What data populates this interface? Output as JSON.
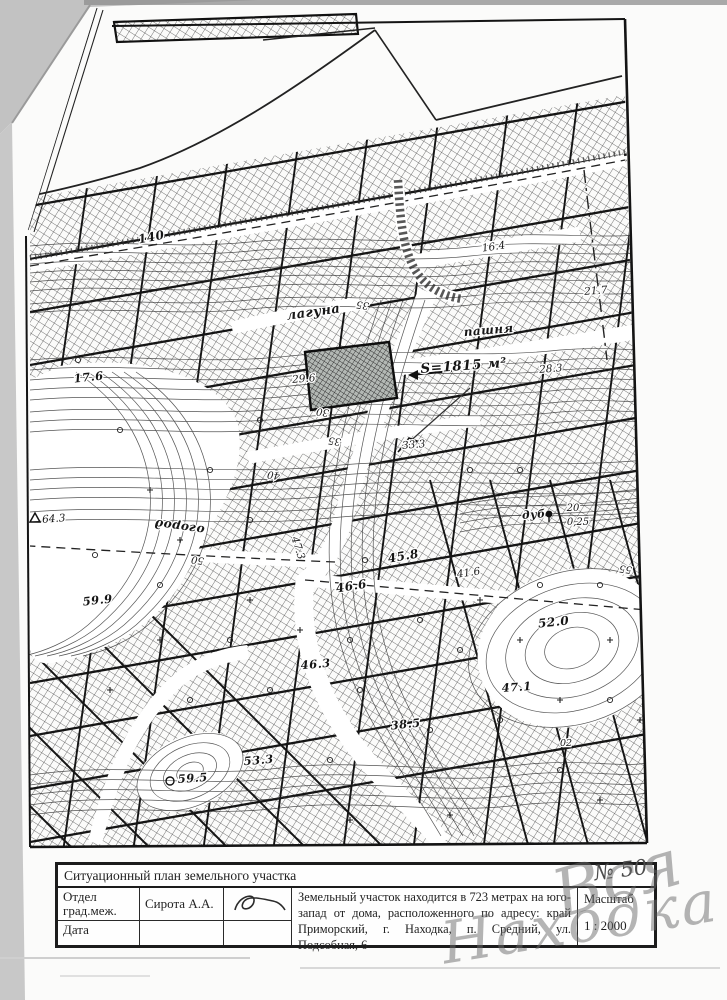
{
  "document": {
    "kind": "Ситуационный план (скан)",
    "stamp_number": "№ 50",
    "watermark": {
      "word1": "Вся",
      "word2": "Находка",
      "color": "#696969"
    }
  },
  "title_block": {
    "title": "Ситуационный план земельного участка",
    "dept_label": "Отдел град.меж.",
    "dept_value": "Сирота А.А.",
    "date_label": "Дата",
    "description": "Земельный участок находится  в 723 метрах на юго-запад  от дома, расположенного  по адресу: край Приморский, г. Находка, п. Средний, ул. Подсобная, 6",
    "scale_label": "Масштаб",
    "scale_value": "1 : 2000"
  },
  "map": {
    "plot_area_label": "S=1815 м²",
    "land_use_labels": [
      "лагуна",
      "пашня",
      "огород",
      "дуб"
    ],
    "labels": [
      {
        "text": "140",
        "x": 152,
        "y": 241,
        "rot": -11,
        "hand": 1,
        "size": 12
      },
      {
        "text": "16.4",
        "x": 494,
        "y": 250,
        "rot": -8,
        "size": 10.5
      },
      {
        "text": "21.7",
        "x": 596,
        "y": 294,
        "rot": -4,
        "size": 10.5
      },
      {
        "text": "лагуна",
        "x": 314,
        "y": 316,
        "rot": -8,
        "hand": 1,
        "size": 13
      },
      {
        "text": "пашня",
        "x": 489,
        "y": 334,
        "rot": -5,
        "hand": 1,
        "size": 12
      },
      {
        "text": "35",
        "x": 363,
        "y": 302,
        "rot": 188,
        "size": 10
      },
      {
        "text": "28.3",
        "x": 551,
        "y": 372,
        "rot": -4,
        "size": 10.5
      },
      {
        "text": "S=1815 м²",
        "x": 464,
        "y": 370,
        "rot": -4,
        "hand": 1,
        "size": 13.5
      },
      {
        "text": "29.6",
        "x": 304,
        "y": 382,
        "rot": -4,
        "size": 10.5
      },
      {
        "text": "17.6",
        "x": 89,
        "y": 381,
        "rot": -6,
        "hand": 1,
        "size": 11.5
      },
      {
        "text": "30",
        "x": 323,
        "y": 409,
        "rot": 188,
        "size": 10
      },
      {
        "text": "33.3",
        "x": 414,
        "y": 448,
        "rot": -5,
        "size": 10.5
      },
      {
        "text": "35",
        "x": 335,
        "y": 438,
        "rot": 188,
        "size": 10
      },
      {
        "text": "40",
        "x": 274,
        "y": 472,
        "rot": 188,
        "size": 10
      },
      {
        "text": "64.3",
        "x": 54,
        "y": 522,
        "rot": -4,
        "size": 10.5
      },
      {
        "text": "огород",
        "x": 180,
        "y": 523,
        "rot": 188,
        "hand": 1,
        "size": 12
      },
      {
        "text": "дуб",
        "x": 534,
        "y": 518,
        "rot": -4,
        "hand": 1,
        "size": 11
      },
      {
        "text": "20",
        "x": 573,
        "y": 511,
        "rot": 0,
        "size": 10
      },
      {
        "text": "0,25",
        "x": 578,
        "y": 525,
        "rot": 0,
        "size": 10
      },
      {
        "text": "47.3",
        "x": 295,
        "y": 549,
        "rot": 72,
        "size": 10.5
      },
      {
        "text": "50",
        "x": 198,
        "y": 557,
        "rot": 188,
        "size": 10
      },
      {
        "text": "45.8",
        "x": 404,
        "y": 560,
        "rot": -10,
        "hand": 1,
        "size": 12
      },
      {
        "text": "41.6",
        "x": 469,
        "y": 576,
        "rot": -8,
        "size": 10.5
      },
      {
        "text": "46.6",
        "x": 352,
        "y": 590,
        "rot": -9,
        "hand": 1,
        "size": 12
      },
      {
        "text": "55",
        "x": 626,
        "y": 566,
        "rot": 188,
        "size": 10
      },
      {
        "text": "52.0",
        "x": 554,
        "y": 626,
        "rot": -6,
        "hand": 1,
        "size": 12
      },
      {
        "text": "59.9",
        "x": 98,
        "y": 604,
        "rot": -6,
        "hand": 1,
        "size": 11.5
      },
      {
        "text": "46.3",
        "x": 316,
        "y": 668,
        "rot": -5,
        "hand": 1,
        "size": 11.5
      },
      {
        "text": "47.1",
        "x": 517,
        "y": 691,
        "rot": -4,
        "hand": 1,
        "size": 11.5
      },
      {
        "text": "38.5",
        "x": 406,
        "y": 728,
        "rot": -6,
        "hand": 1,
        "size": 11.5
      },
      {
        "text": "02",
        "x": 566,
        "y": 746,
        "rot": 0,
        "size": 9.5
      },
      {
        "text": "53.3",
        "x": 259,
        "y": 764,
        "rot": -5,
        "hand": 1,
        "size": 11.5
      },
      {
        "text": "59.5",
        "x": 193,
        "y": 782,
        "rot": -4,
        "hand": 1,
        "size": 11.5
      }
    ]
  }
}
